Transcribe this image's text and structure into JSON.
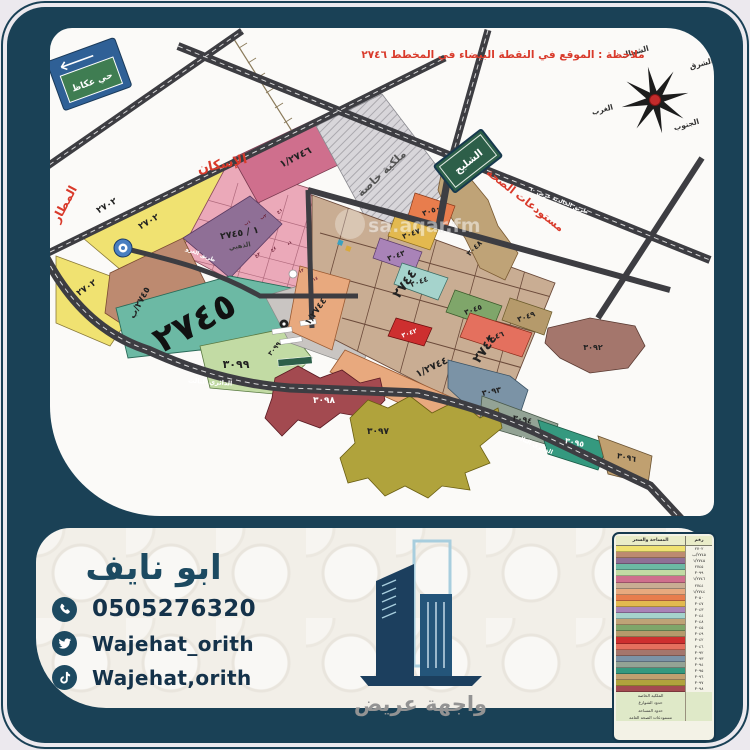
{
  "map": {
    "note": "ملاحظة : الموقع في النقطة البيضاء في المخطط ٢٧٤٦",
    "watermark": "sa.aqar.fm",
    "signs": {
      "okaz": "حي عكاظ",
      "shulayh": "الشليح"
    },
    "compass": {
      "north": "الشمال",
      "east": "الشرق",
      "west": "الغرب",
      "south": "الجنوب"
    },
    "areas": {
      "airport": "المطار",
      "housing": "الإسكان",
      "health_warehouses": "مستودعات الصحة",
      "private_property": "ملكية خاصة"
    },
    "roads": {
      "ring3": "الدائري الثالث",
      "ghazu": "طريق الغزو",
      "khalidiya": "طريق الخالدية عرض ٦٠",
      "dhahabi": "الذهبي"
    },
    "plots": {
      "p2702": "٢٧٠٢",
      "p2745": "٢٧٤٥",
      "p2745b": "٢٧٤٥/ب",
      "p2745_1": "١ / ٢٧٤٥",
      "p2746_1": "١/٢٧٤٦",
      "p2744": "٢٧٤٤",
      "p2744_1": "١/٢٧٤٤",
      "p3099": "٣٠٩٩",
      "p3042": "٣٠٤٢",
      "p3043": "٣٠٤٣",
      "p3044": "٣٠٤٤",
      "p3045": "٣٠٤٥",
      "p3046": "٣٠٤٦",
      "p3047": "٣٠٤٧",
      "p3048": "٣٠٤٨",
      "p3049": "٣٠٤٩",
      "p3050": "٣٠٥٠",
      "p3092": "٣٠٩٢",
      "p3093": "٣٠٩٣",
      "p3094": "٣٠٩٤",
      "p3095": "٣٠٩٥",
      "p3096": "٣٠٩٦",
      "p3097": "٣٠٩٧",
      "p3098": "٣٠٩٨"
    },
    "cells": [
      "١ب",
      "٢ب",
      "١ج",
      "٣ج",
      "٤ج",
      "١د",
      "١٣",
      "١٤"
    ]
  },
  "contact": {
    "name": "ابو نايف",
    "phone": "0505276320",
    "twitter": "Wajehat_orith",
    "tiktok": "Wajehat,orith"
  },
  "logo": {
    "name": "واجهة عريض"
  },
  "legend": {
    "header_det": "المساحة والسعر",
    "header_num": "رقم القطعة",
    "rows": [
      {
        "color": "#f0e271",
        "num": "٢٧٠٢"
      },
      {
        "color": "#bd8a70",
        "num": "٢٧٤٥/ب"
      },
      {
        "color": "#8f6f96",
        "num": "١/٢٧٤٥"
      },
      {
        "color": "#6cb9a4",
        "num": "٢٧٤٥"
      },
      {
        "color": "#c2dba4",
        "num": "٣٠٩٩"
      },
      {
        "color": "#cf6f8d",
        "num": "١/٢٧٤٦"
      },
      {
        "color": "#c9ad93",
        "num": "٢٧٤٤"
      },
      {
        "color": "#e8a97e",
        "num": "١/٢٧٤٤"
      },
      {
        "color": "#e87d4d",
        "num": "٣٠٥٠"
      },
      {
        "color": "#e3b94f",
        "num": "٣٠٤٧"
      },
      {
        "color": "#a983b8",
        "num": "٣٠٤٣"
      },
      {
        "color": "#a5d3cc",
        "num": "٣٠٤٤"
      },
      {
        "color": "#bfa377",
        "num": "٣٠٤٨"
      },
      {
        "color": "#7fa66a",
        "num": "٣٠٤٥"
      },
      {
        "color": "#b59a6b",
        "num": "٣٠٤٩"
      },
      {
        "color": "#cd2f2f",
        "num": "٣٠٤٢"
      },
      {
        "color": "#e4705e",
        "num": "٣٠٤٦"
      },
      {
        "color": "#a4766c",
        "num": "٣٠٩٢"
      },
      {
        "color": "#7b93a6",
        "num": "٣٠٩٣"
      },
      {
        "color": "#93a395",
        "num": "٣٠٩٤"
      },
      {
        "color": "#35997f",
        "num": "٣٠٩٥"
      },
      {
        "color": "#c0a070",
        "num": "٣٠٩٦"
      },
      {
        "color": "#b0a33c",
        "num": "٣٠٩٧"
      },
      {
        "color": "#a34a50",
        "num": "٣٠٩٨"
      }
    ],
    "footer": [
      "الملكية الخاصة",
      "حدود الشوارع",
      "حدود المساحة",
      "مستودعات الصحة العامة"
    ]
  },
  "colors": {
    "navy": "#1a4156",
    "accent_red": "#d93a2b",
    "teal_plot": "#6cb9a4"
  }
}
